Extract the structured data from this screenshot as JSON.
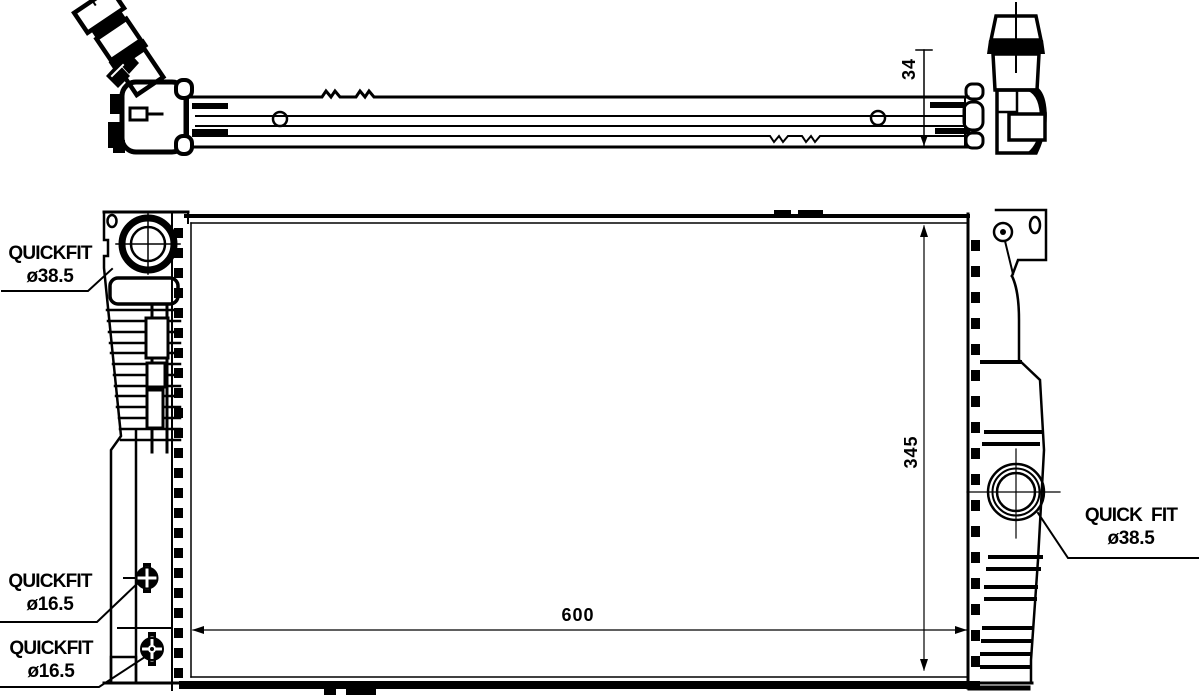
{
  "drawing": {
    "background_color": "#ffffff",
    "line_color": "#000000",
    "labels": {
      "quickfit_38_left": {
        "line1": "QUICKFIT",
        "line2": "ø38.5"
      },
      "quickfit_16_upper": {
        "line1": "QUICKFIT",
        "line2": "ø16.5"
      },
      "quickfit_16_lower": {
        "line1": "QUICKFIT",
        "line2": "ø16.5"
      },
      "quickfit_38_right": {
        "line1": "QUICK  FIT",
        "line2": "ø38.5"
      }
    },
    "dimensions": {
      "depth": "34",
      "height": "345",
      "width": "600"
    }
  }
}
